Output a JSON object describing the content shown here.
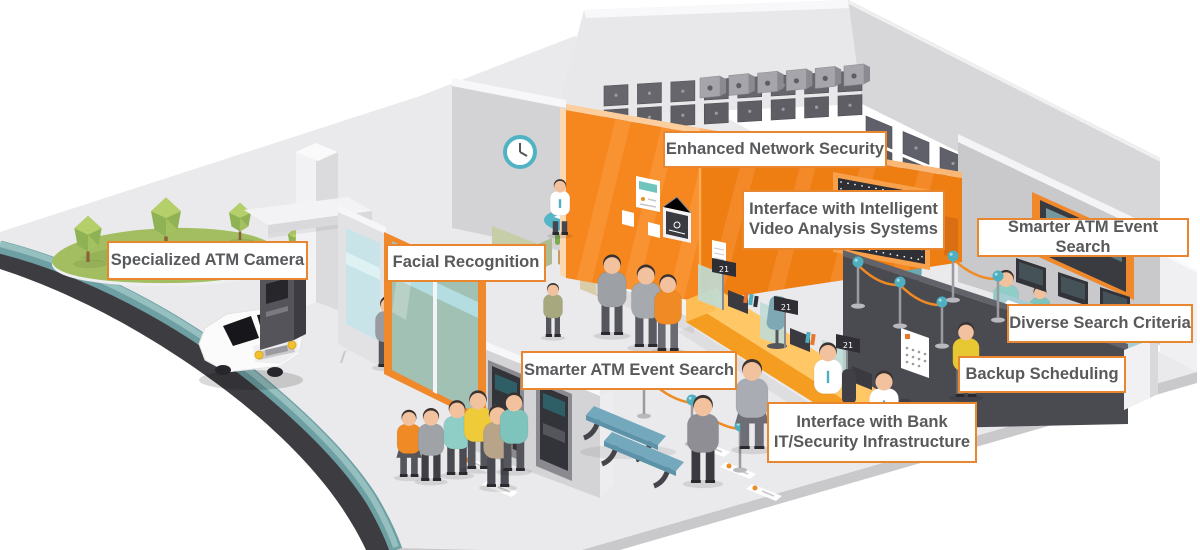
{
  "labels": {
    "specialized_atm_camera": "Specialized ATM Camera",
    "facial_recognition": "Facial Recognition",
    "enhanced_network_security": "Enhanced Network Security",
    "interface_intelligent_video": "Interface with Intelligent\nVideo Analysis Systems",
    "smarter_atm_event_search_right": "Smarter ATM Event Search",
    "diverse_search_criteria": "Diverse Search Criteria",
    "backup_scheduling": "Backup Scheduling",
    "smarter_atm_event_search_bottom": "Smarter ATM Event Search",
    "interface_bank_it": "Interface with Bank\nIT/Security Infrastructure"
  },
  "style": {
    "label_border": "#E8872F",
    "label_bg": "#FFFFFF",
    "label_text": "#58595B",
    "accent_orange": "#F0882C",
    "wall_orange": "#F6871F",
    "floor_gray": "#EAEAEC",
    "road_dark": "#3D3D41",
    "curb_teal": "#78A8AB",
    "grass_green": "#A3BE61",
    "teal": "#4FAFC0",
    "counter_yellow": "#F9A123",
    "dark_wall": "#4A4A51"
  },
  "scene": {
    "counter_signs": [
      {
        "x": 712,
        "y": 258,
        "text": "21"
      },
      {
        "x": 774,
        "y": 296,
        "text": "21"
      },
      {
        "x": 836,
        "y": 334,
        "text": "21"
      }
    ],
    "trees": [
      {
        "x": 88,
        "y": 262,
        "s": 1.05
      },
      {
        "x": 166,
        "y": 248,
        "s": 1.15
      },
      {
        "x": 240,
        "y": 240,
        "s": 0.85
      },
      {
        "x": 295,
        "y": 252,
        "s": 0.55
      }
    ],
    "figure_groups": {
      "back": [
        {
          "x": 912,
          "y": 298,
          "h": 56,
          "shirt": "#6FA8B0",
          "pants": "#4A4A52"
        },
        {
          "x": 1006,
          "y": 340,
          "h": 74,
          "shirt": "#8FCEC6",
          "pants": "#4A4A52"
        },
        {
          "x": 1040,
          "y": 342,
          "h": 60,
          "shirt": "#7FC4BC",
          "pants": "#44444C",
          "sit": true
        }
      ],
      "door": [
        {
          "x": 388,
          "y": 366,
          "h": 74,
          "shirt": "#9A9AA0",
          "pants": "#55555C"
        }
      ],
      "front": [
        {
          "x": 553,
          "y": 336,
          "h": 56,
          "shirt": "#A8A87E",
          "pants": "#55555C"
        },
        {
          "x": 560,
          "y": 234,
          "h": 58,
          "shirt": "#FFFFFF",
          "pants": "#464650",
          "tie": "#4FAFC0",
          "sit": true
        },
        {
          "x": 612,
          "y": 334,
          "h": 84,
          "shirt": "#9DA0A5",
          "pants": "#55555C"
        },
        {
          "x": 646,
          "y": 346,
          "h": 86,
          "shirt": "#A6A9AE",
          "pants": "#5A5A62"
        },
        {
          "x": 668,
          "y": 350,
          "h": 80,
          "shirt": "#F08A24",
          "pants": "#6A6A72"
        },
        {
          "x": 828,
          "y": 420,
          "h": 82,
          "shirt": "#FFFFFF",
          "pants": "#464650",
          "tie": "#4FAFC0",
          "sit": true,
          "chair": true
        },
        {
          "x": 884,
          "y": 452,
          "h": 86,
          "shirt": "#FFFFFF",
          "pants": "#464650",
          "tie": "#4FAFC0",
          "sit": true,
          "chair": true
        },
        {
          "x": 752,
          "y": 448,
          "h": 94,
          "shirt": "#A9ACB2",
          "pants": "#6E6E76",
          "female": true
        },
        {
          "x": 703,
          "y": 482,
          "h": 92,
          "shirt": "#8E8E94",
          "pants": "#3A3A40"
        },
        {
          "x": 966,
          "y": 396,
          "h": 78,
          "shirt": "#E8C832",
          "pants": "#6E6E76"
        },
        {
          "x": 409,
          "y": 476,
          "h": 70,
          "shirt": "#F08A24",
          "pants": "#55555C",
          "female": true
        },
        {
          "x": 431,
          "y": 480,
          "h": 76,
          "shirt": "#9FA3A8",
          "pants": "#3F3F45"
        },
        {
          "x": 457,
          "y": 474,
          "h": 78,
          "shirt": "#8FCEC6",
          "pants": "#4A4A52"
        },
        {
          "x": 478,
          "y": 468,
          "h": 82,
          "shirt": "#EFCB3A",
          "pants": "#55555C"
        },
        {
          "x": 498,
          "y": 486,
          "h": 86,
          "shirt": "#B8A489",
          "pants": "#4A4A52"
        },
        {
          "x": 514,
          "y": 470,
          "h": 82,
          "shirt": "#7FC4BC",
          "pants": "#55555C"
        }
      ]
    },
    "stanchion_chains": [
      [
        [
          644,
          372
        ],
        [
          692,
          400
        ],
        [
          740,
          426
        ]
      ],
      [
        [
          858,
          262
        ],
        [
          900,
          282
        ],
        [
          942,
          302
        ]
      ],
      [
        [
          953,
          256
        ],
        [
          998,
          276
        ]
      ]
    ],
    "mats": [
      {
        "x": 464,
        "y": 456
      },
      {
        "x": 488,
        "y": 480
      },
      {
        "x": 700,
        "y": 440
      },
      {
        "x": 726,
        "y": 462
      },
      {
        "x": 752,
        "y": 484
      }
    ],
    "safebox_rows": [
      {
        "x1": 604,
        "y1": 86,
        "x2": 838,
        "y2": 72,
        "n": 8,
        "w": 24,
        "h": 20,
        "c": "#66666C"
      },
      {
        "x1": 604,
        "y1": 110,
        "x2": 838,
        "y2": 96,
        "n": 8,
        "w": 24,
        "h": 20,
        "c": "#5E5E64"
      },
      {
        "x1": 866,
        "y1": 116,
        "x2": 1014,
        "y2": 178,
        "n": 5,
        "w": 26,
        "h": 22,
        "c": "#60606A"
      },
      {
        "x1": 866,
        "y1": 142,
        "x2": 1014,
        "y2": 204,
        "n": 5,
        "w": 26,
        "h": 22,
        "c": "#585860"
      }
    ],
    "ledge_row": {
      "x1": 700,
      "y1": 78,
      "x2": 844,
      "y2": 66,
      "n": 6
    }
  }
}
